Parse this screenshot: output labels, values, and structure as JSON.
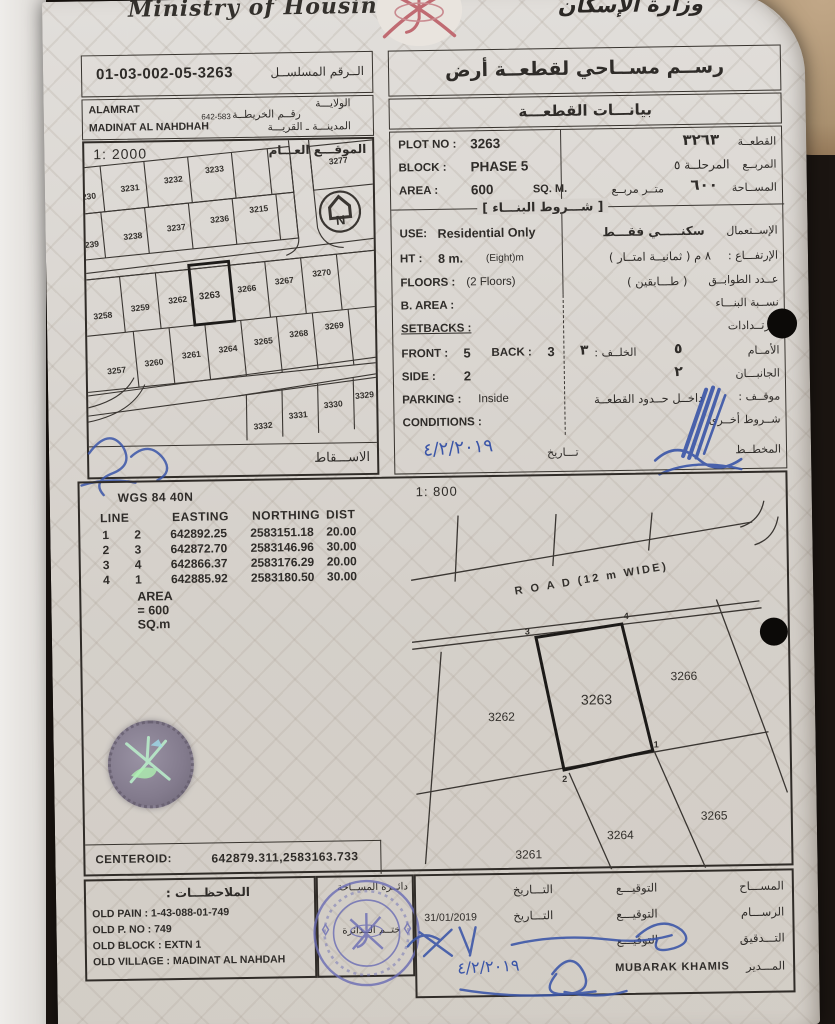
{
  "header": {
    "ministry_en": "Ministry of Housing",
    "ministry_ar": "وزارة الإسكان",
    "emblem": "oman-national-emblem"
  },
  "serial_box": {
    "label_ar": "الــرقم المسلســل",
    "value": "01-03-002-05-3263"
  },
  "location_box": {
    "wilayat_en": "ALAMRAT",
    "wilayat_label_ar": "الولايـــة",
    "map_no": "642-583",
    "map_label_ar": "رقــم الخريطــة",
    "city_en": "MADINAT AL NAHDHAH",
    "city_label_ar": "المدينـــة ـ القريـــة"
  },
  "title_box": {
    "title_ar": "رســم مســاحي لقطعــة أرض",
    "subtitle_ar": "بيانـــات القطعـــة"
  },
  "general_map": {
    "scale": "1: 2000",
    "label_ar": "الموقـــع العـــام",
    "footer_ar": "الاســـقاط",
    "north": "N",
    "plots": [
      "3230",
      "3231",
      "3232",
      "3233",
      "3277",
      "3239",
      "3238",
      "3237",
      "3236",
      "3215",
      "3258",
      "3259",
      "3262",
      "3263",
      "3266",
      "3267",
      "3270",
      "3257",
      "3260",
      "3261",
      "3264",
      "3265",
      "3268",
      "3269",
      "3332",
      "3331",
      "3330",
      "3329"
    ]
  },
  "plot_data": {
    "plot_no_label": "PLOT NO :",
    "plot_no": "3263",
    "plot_no_ar": "٣٢٦٣",
    "plot_label_ar": "القطعــة",
    "block_label": "BLOCK :",
    "block": "PHASE 5",
    "block_ar": "المرحلــة ٥",
    "block_label_ar": "المربــع",
    "area_label": "AREA :",
    "area": "600",
    "area_unit": "SQ. M.",
    "area_ar": "٦٠٠",
    "area_unit_ar": "متــر مربــع",
    "area_label_ar": "المســاحة",
    "conditions_header_ar": "[ شـــروط البنـــاء ]",
    "use_label": "USE:",
    "use": "Residential Only",
    "use_ar": "سكنـــــي فقـــط",
    "use_label_ar": "الإســتعمال",
    "ht_label": "HT :",
    "ht": "8 m.",
    "ht_note": "(Eight)m",
    "ht_ar": "٨  م  ( ثمانيــة امتــار )",
    "ht_label_ar": "الإرتفـــاع :",
    "floors_label": "FLOORS :",
    "floors": "(2 Floors)",
    "floors_ar": "( طـــابقين )",
    "floors_label_ar": "عــدد الطوابــق",
    "barea_label": "B. AREA :",
    "barea_label_ar": "نســبة البنـــاء",
    "setbacks_label": "SETBACKS :",
    "setbacks_label_ar": "الإرتــدادات",
    "front_label": "FRONT :",
    "front": "5",
    "back_label": "BACK :",
    "back": "3",
    "front_label_ar": "الأمــام",
    "front_ar": "٥",
    "back_label_ar": "الخلــف :",
    "back_ar": "٣",
    "side_label": "SIDE :",
    "side": "2",
    "side_label_ar": "الجانبـــان",
    "side_ar": "٢",
    "parking_label": "PARKING :",
    "parking": "Inside",
    "parking_label_ar": "موقــف :",
    "parking_ar": "داخــل حــدود القطعــة",
    "conditions_label": "CONDITIONS :",
    "conditions_label_ar": "شــروط أخــرى",
    "date_label_ar": "تـــاريخ",
    "date_handwritten_ar": "٤/٢/٢٠١٩",
    "planner_label_ar": "المخطــط"
  },
  "survey": {
    "datum": "WGS 84  40N",
    "scale": "1: 800",
    "table": {
      "headers": [
        "LINE",
        "EASTING",
        "NORTHING",
        "DIST"
      ],
      "rows": [
        [
          "1",
          "2",
          "642892.25",
          "2583151.18",
          "20.00"
        ],
        [
          "2",
          "3",
          "642872.70",
          "2583146.96",
          "30.00"
        ],
        [
          "3",
          "4",
          "642866.37",
          "2583176.29",
          "20.00"
        ],
        [
          "4",
          "1",
          "642885.92",
          "2583180.50",
          "30.00"
        ]
      ],
      "area_note": "AREA = 600  SQ.m"
    },
    "centeroid_label": "CENTEROID:",
    "centeroid_value": "642879.311,2583163.733",
    "plan": {
      "road_label": "R O A D (12 m WIDE)",
      "plot_main": "3263",
      "plot_left": "3262",
      "plot_right": "3266",
      "plot_bottom_left": "3261",
      "plot_bottom_mid": "3264",
      "plot_bottom_right": "3265",
      "corner_1": "1",
      "corner_2": "2",
      "corner_3": "3",
      "corner_4": "4"
    }
  },
  "notes_box": {
    "title_ar": "الملاحظـــات :",
    "lines": [
      "OLD PAIN : 1-43-088-01-749",
      "OLD P. NO : 749",
      "OLD BLOCK : EXTN 1",
      "OLD VILLAGE : MADINAT AL NAHDAH"
    ]
  },
  "stamp_box": {
    "dept_label_ar": "دائــرة المســاحة",
    "seal_label_ar": "ختــم الــدائرة"
  },
  "signatures": {
    "surveyor_label_ar": "المســـاح",
    "draftsman_label_ar": "الرســـام",
    "checker_label_ar": "التـــدقيق",
    "manager_label_ar": "المـــدير",
    "signature_label_ar": "التوقيـــع",
    "date_label_ar": "التـــاريخ",
    "draftsman_date": "31/01/2019",
    "manager_name": "MUBARAK KHAMIS",
    "manager_date_handwritten_ar": "٤/٢/٢٠١٩"
  },
  "colors": {
    "ink_blue": "#3a55a8",
    "stamp_blue": "#6a6cb4",
    "emblem_red": "#c06b72",
    "paper": "#d7d3ce"
  }
}
